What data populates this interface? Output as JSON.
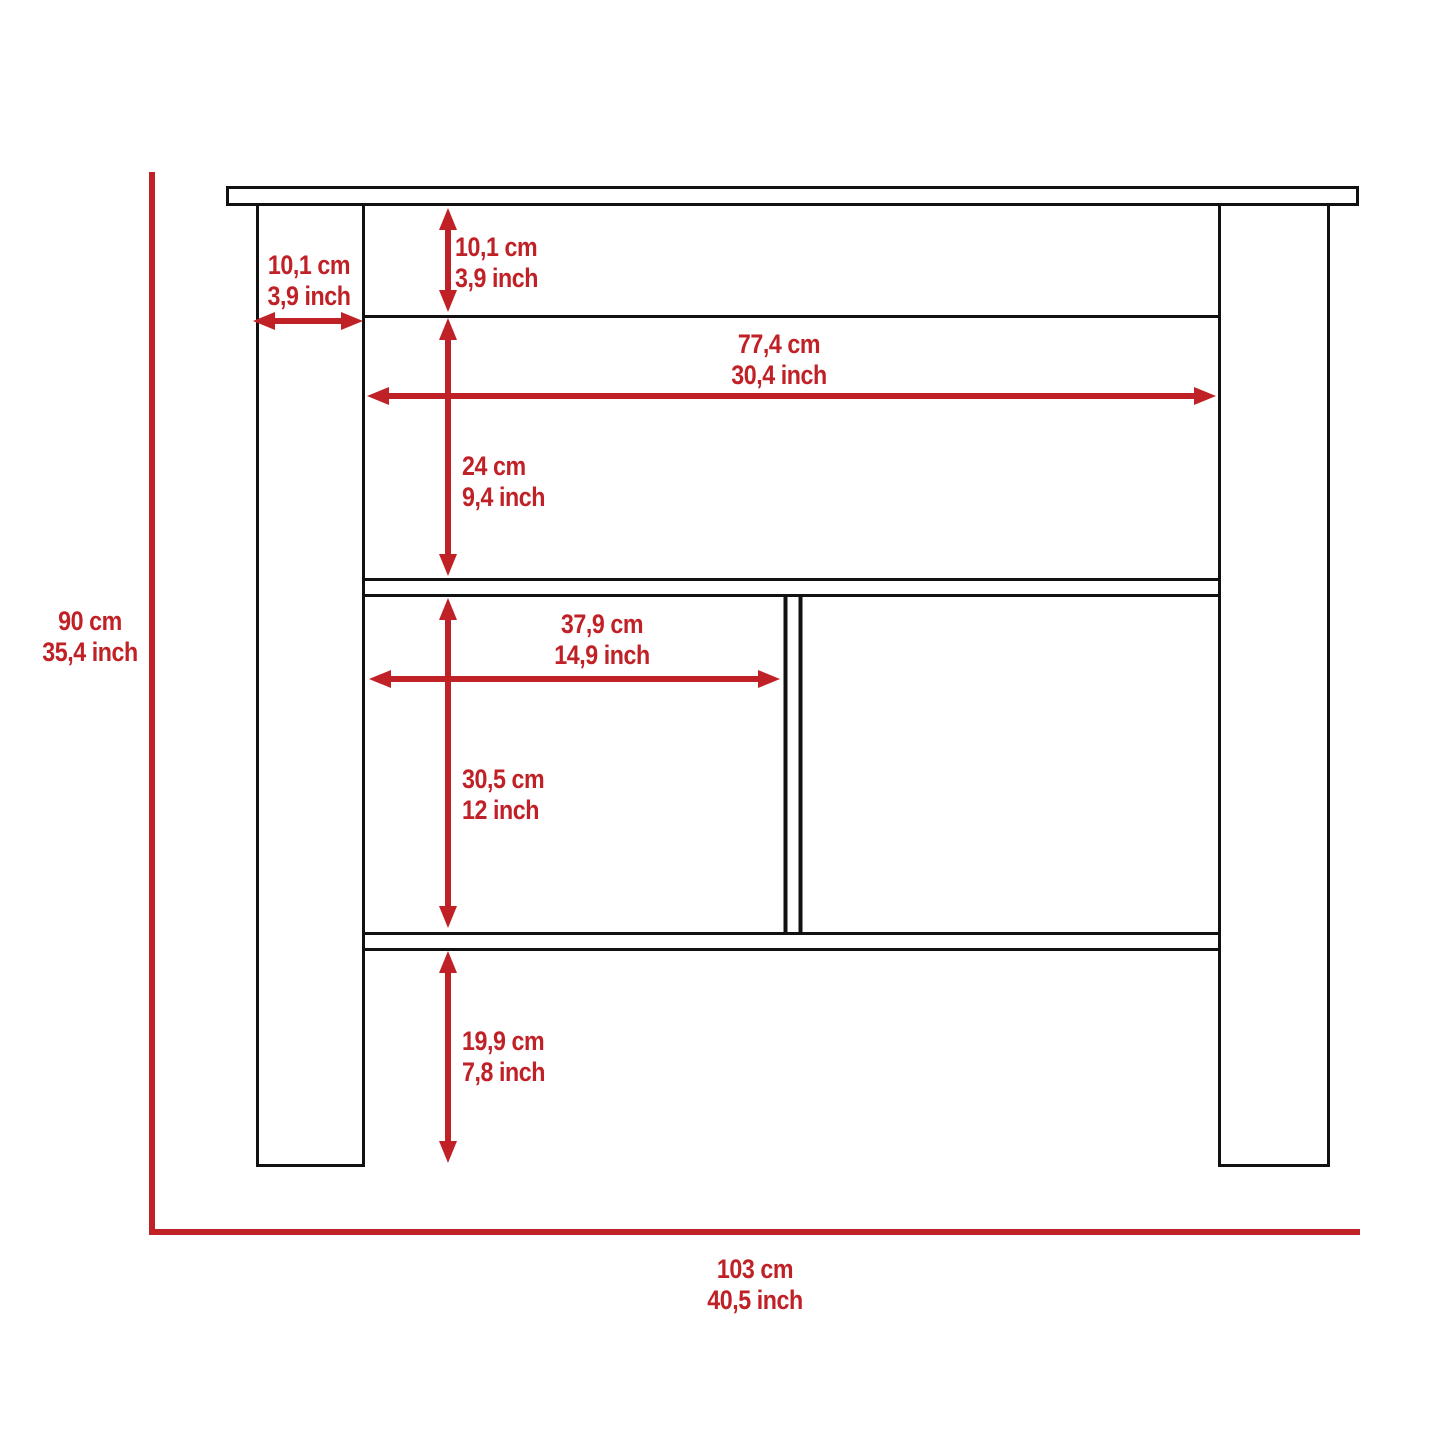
{
  "figure": {
    "type": "furniture-dimension-diagram",
    "subject": "kitchen island console with open shelves",
    "accent_color": "#c02127",
    "line_color": "#111111",
    "dimensions": {
      "leg_width": {
        "cm": "10,1 cm",
        "inch": "3,9 inch"
      },
      "apron_height": {
        "cm": "10,1 cm",
        "inch": "3,9 inch"
      },
      "inner_width": {
        "cm": "77,4 cm",
        "inch": "30,4 inch"
      },
      "open_shelf_height": {
        "cm": "24 cm",
        "inch": "9,4 inch"
      },
      "compartment_width": {
        "cm": "37,9 cm",
        "inch": "14,9 inch"
      },
      "compartment_height": {
        "cm": "30,5 cm",
        "inch": "12 inch"
      },
      "bottom_clearance": {
        "cm": "19,9 cm",
        "inch": "7,8 inch"
      },
      "overall_height": {
        "cm": "90 cm",
        "inch": "35,4 inch"
      },
      "overall_width": {
        "cm": "103 cm",
        "inch": "40,5 inch"
      }
    }
  }
}
